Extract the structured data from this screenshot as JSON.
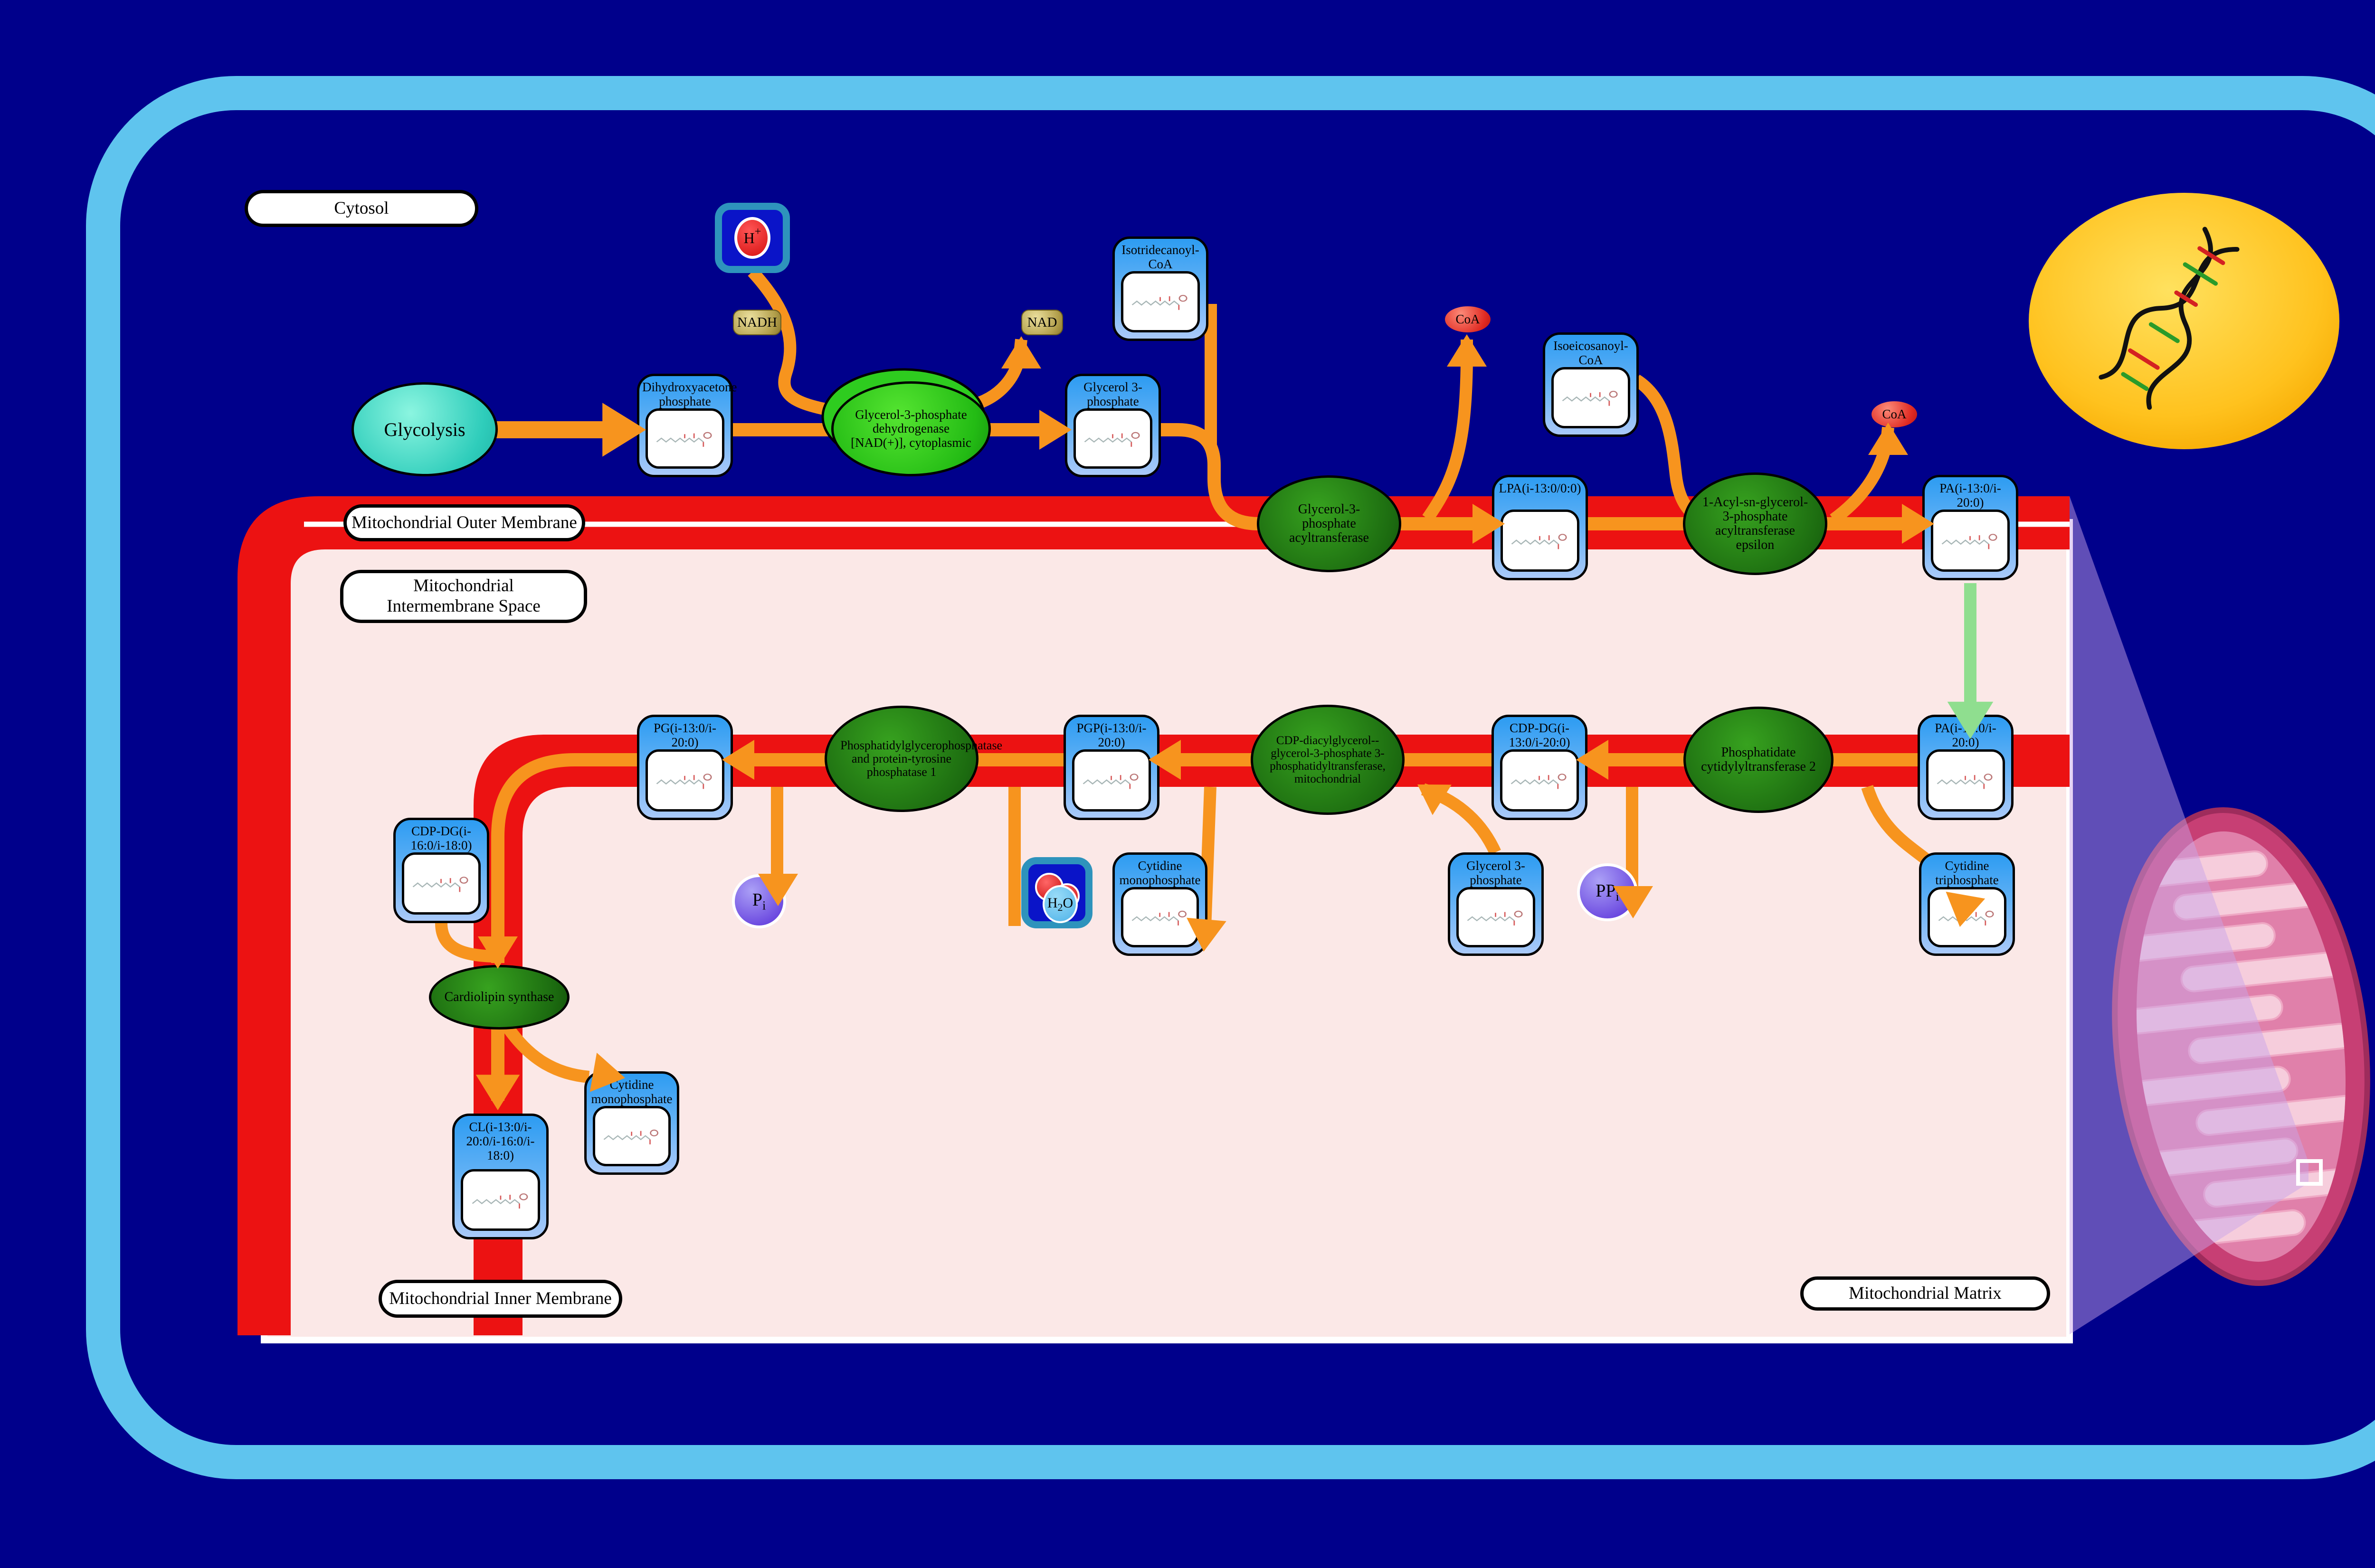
{
  "title": "Cardiolipin biosynthesis pathway diagram",
  "region_labels": {
    "cytosol": "Cytosol",
    "outer_membrane": "Mitochondrial Outer Membrane",
    "intermembrane_space": "Mitochondrial Intermembrane Space",
    "inner_membrane": "Mitochondrial Inner Membrane",
    "matrix": "Mitochondrial Matrix"
  },
  "process": {
    "glycolysis": "Glycolysis"
  },
  "metabolites": {
    "dhap": {
      "label": "Dihydroxyacetone phosphate"
    },
    "g3p_cytosol": {
      "label": "Glycerol 3-phosphate"
    },
    "isotridecanoyl_coa": {
      "label": "Isotridecanoyl-CoA"
    },
    "isoeicosanoyl_coa": {
      "label": "Isoeicosanoyl-CoA"
    },
    "lpa": {
      "label": "LPA(i-13:0/0:0)"
    },
    "pa_outer": {
      "label": "PA(i-13:0/i-20:0)"
    },
    "pa_inner": {
      "label": "PA(i-13:0/i-20:0)"
    },
    "cdp_dg_inner": {
      "label": "CDP-DG(i-13:0/i-20:0)"
    },
    "pgp": {
      "label": "PGP(i-13:0/i-20:0)"
    },
    "pg": {
      "label": "PG(i-13:0/i-20:0)"
    },
    "cdp_dg_left": {
      "label": "CDP-DG(i-16:0/i-18:0)"
    },
    "cl": {
      "label": "CL(i-13:0/i-20:0/i-16:0/i-18:0)"
    },
    "cmp_left": {
      "label": "Cytidine monophosphate"
    },
    "cmp_matrix": {
      "label": "Cytidine monophosphate"
    },
    "g3p_matrix": {
      "label": "Glycerol 3-phosphate"
    },
    "ctp": {
      "label": "Cytidine triphosphate"
    }
  },
  "enzymes": {
    "gpd1": {
      "label": "Glycerol-3-phosphate dehydrogenase [NAD(+)], cytoplasmic"
    },
    "gpat": {
      "label": "Glycerol-3-phosphate acyltransferase"
    },
    "agpat": {
      "label": "1-Acyl-sn-glycerol-3-phosphate acyltransferase epsilon"
    },
    "cds2": {
      "label": "Phosphatidate cytidylyltransferase 2"
    },
    "pgs1": {
      "label": "CDP-diacylglycerol--glycerol-3-phosphate 3-phosphatidyltransferase, mitochondrial"
    },
    "ptpmt1": {
      "label": "Phosphatidylglycerophosphatase and protein-tyrosine phosphatase 1"
    },
    "crls1": {
      "label": "Cardiolipin synthase"
    }
  },
  "small_molecules": {
    "nadh": "NADH",
    "nad": "NAD",
    "coa_first": "CoA",
    "coa_second": "CoA",
    "proton": "H",
    "proton_charge": "+",
    "pi_main": "P",
    "pi_sub": "i",
    "ppi_main": "PP",
    "ppi_sub": "i",
    "h2o_h": "H",
    "h2o_2": "2",
    "h2o_o": "O"
  },
  "colors": {
    "background_navy": "#00008B",
    "cell_wall_blue": "#5FC4EE",
    "membrane_red": "#EC1212",
    "matrix_pink": "#FBE8E7",
    "pathway_orange": "#F7941E",
    "transport_green": "#8FDE8F",
    "metabolite_box_blue": "#2D9CF2",
    "enzyme_green_dark": "#1C6B10",
    "enzyme_green_bright": "#23BB14",
    "nucleus_gold": "#FFC21E",
    "mitochondrion_pink": "#C73F74"
  }
}
